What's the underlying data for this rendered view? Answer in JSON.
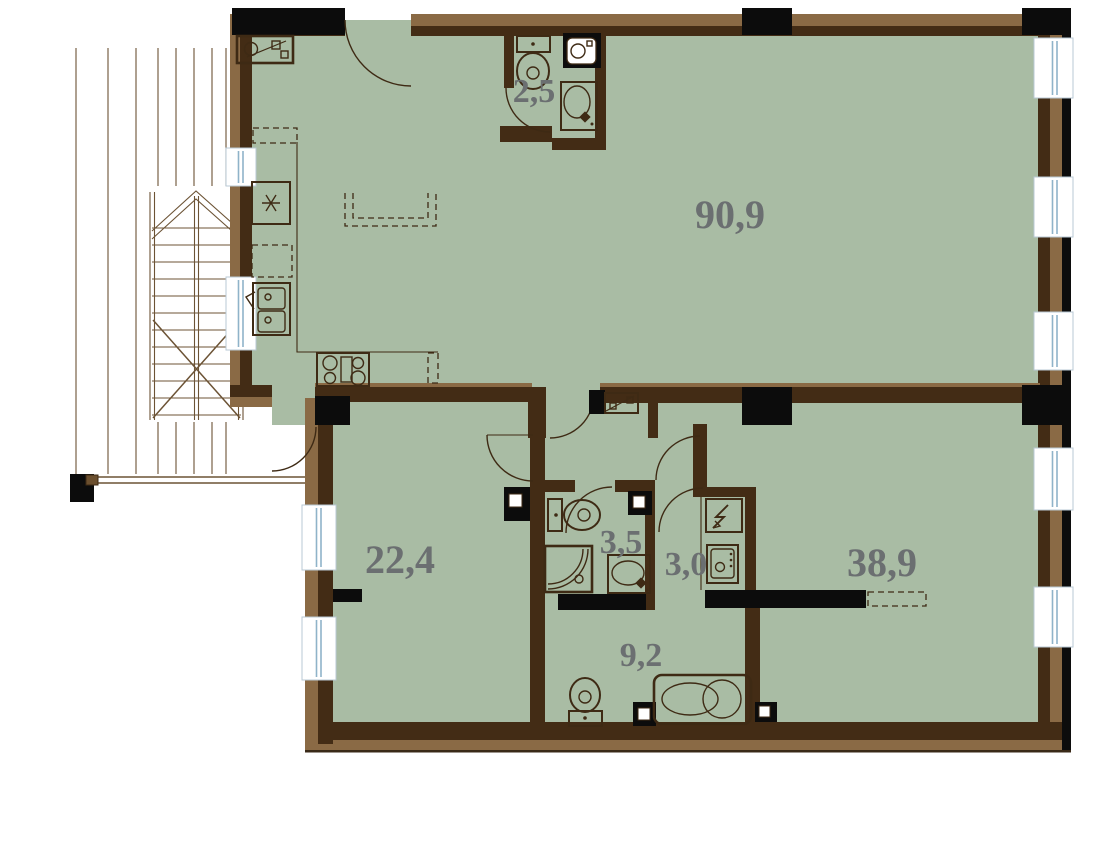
{
  "title": "Apartment floor plan",
  "palette": {
    "floor": "#a9bca4",
    "wall_dark": "#432c15",
    "wall_light": "#8a6a45",
    "black": "#0c0c0c",
    "line": "#3e2a14",
    "window_blue": "#8fb3c9",
    "label": "#6b6f71",
    "deck_line": "#6c5335"
  },
  "rooms": [
    {
      "id": "living-kitchen",
      "area": "90,9"
    },
    {
      "id": "bathroom-upper",
      "area": "2,5"
    },
    {
      "id": "room-left",
      "area": "22,4"
    },
    {
      "id": "shower-room",
      "area": "3,5"
    },
    {
      "id": "hall-closet",
      "area": "3,0"
    },
    {
      "id": "room-right",
      "area": "38,9"
    },
    {
      "id": "bathroom-lower",
      "area": "9,2"
    }
  ],
  "fixtures": [
    "refrigerator",
    "dishwasher",
    "kitchen-sink",
    "stove",
    "kitchen-island",
    "laundry-box",
    "toilet",
    "washing-machine",
    "vanity-sink",
    "shower-cabin",
    "bathtub",
    "electrical-panel",
    "vent-shaft",
    "staircase",
    "terrace-deck",
    "window",
    "door"
  ]
}
